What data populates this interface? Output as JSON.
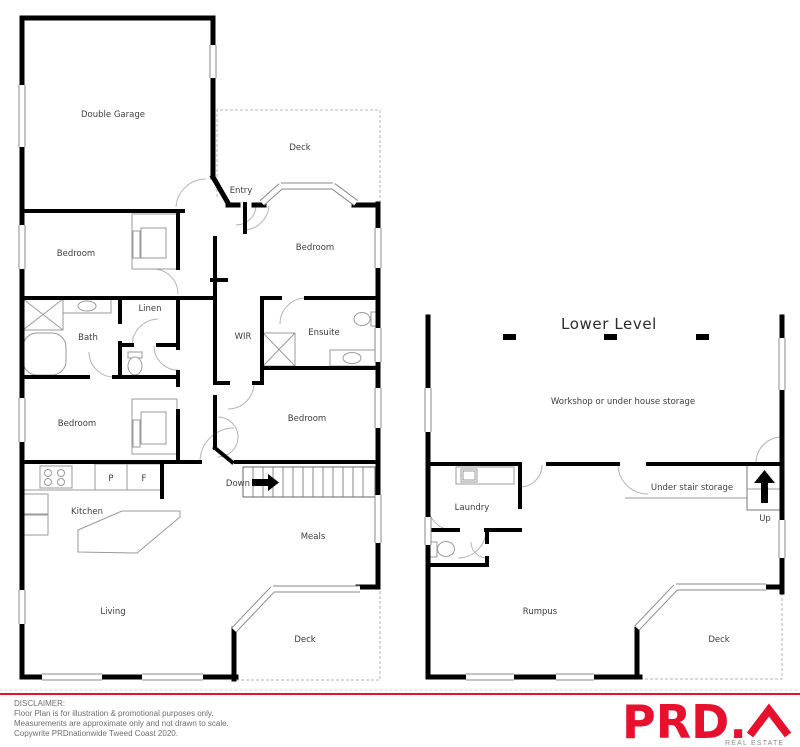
{
  "upper_level": {
    "rooms": {
      "double_garage": "Double Garage",
      "deck_top": "Deck",
      "entry": "Entry",
      "bedroom_top_left": "Bedroom",
      "bedroom_top_right": "Bedroom",
      "linen": "Linen",
      "bath": "Bath",
      "wir": "WIR",
      "ensuite": "Ensuite",
      "bedroom_mid_left": "Bedroom",
      "bedroom_mid_right": "Bedroom",
      "pantry_abbr": "P",
      "fridge_abbr": "F",
      "stairs_down": "Down",
      "kitchen": "Kitchen",
      "meals": "Meals",
      "living": "Living",
      "deck_bottom": "Deck"
    }
  },
  "lower_level": {
    "title": "Lower Level",
    "rooms": {
      "workshop": "Workshop or under house storage",
      "laundry": "Laundry",
      "under_stair_storage": "Under stair storage",
      "stairs_up": "Up",
      "rumpus": "Rumpus",
      "deck": "Deck"
    }
  },
  "footer": {
    "disclaimer_title": "DISCLAIMER:",
    "lines": [
      "Floor Plan is for illustration & promotional purposes only.",
      "Measurements are approximate only and not drawn to scale.",
      "Copywrite PRDnationwide Tweed Coast 2020."
    ],
    "brand": {
      "name": "PRD.",
      "tagline": "REAL ESTATE",
      "accent_color": "#e8112d",
      "wall_color": "#000000"
    }
  }
}
